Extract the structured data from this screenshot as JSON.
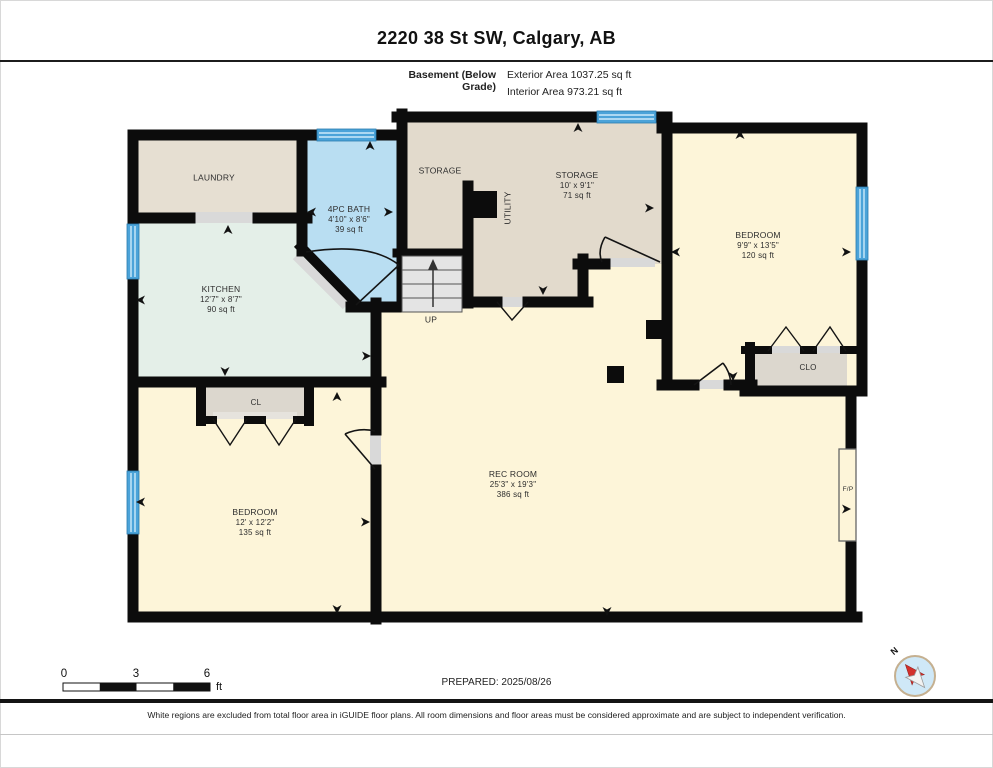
{
  "header": {
    "address": "2220 38 St SW, Calgary, AB",
    "level_label": "Basement (Below Grade)",
    "exterior_area": "Exterior Area 1037.25 sq ft",
    "interior_area": "Interior Area 973.21 sq ft"
  },
  "rooms": {
    "laundry": {
      "name": "LAUNDRY"
    },
    "bath": {
      "name": "4PC BATH",
      "dims": "4'10\" x 8'6\"",
      "area": "39 sq ft"
    },
    "storage_small": {
      "name": "STORAGE"
    },
    "storage": {
      "name": "STORAGE",
      "dims": "10' x 9'1\"",
      "area": "71 sq ft"
    },
    "utility": {
      "name": "UTILITY"
    },
    "bedroom_right": {
      "name": "BEDROOM",
      "dims": "9'9\" x 13'5\"",
      "area": "120 sq ft"
    },
    "kitchen": {
      "name": "KITCHEN",
      "dims": "12'7\" x 8'7\"",
      "area": "90 sq ft"
    },
    "closet_cl": {
      "name": "CL"
    },
    "closet_clo": {
      "name": "CLO"
    },
    "rec_room": {
      "name": "REC ROOM",
      "dims": "25'3\" x 19'3\"",
      "area": "386 sq ft"
    },
    "bedroom_left": {
      "name": "BEDROOM",
      "dims": "12' x 12'2\"",
      "area": "135 sq ft"
    }
  },
  "annotations": {
    "stairs_label": "UP",
    "fireplace_label": "F/P",
    "compass_north": "N"
  },
  "scale_bar": {
    "tick0": "0",
    "tick1": "3",
    "tick2": "6",
    "unit": "ft"
  },
  "footer": {
    "prepared": "PREPARED: 2025/08/26",
    "disclaimer": "White regions are excluded from total floor area in iGUIDE floor plans. All room dimensions and floor areas must be considered approximate and are subject to independent verification."
  },
  "colors": {
    "wall": "#0c0c0c",
    "window": "#4ba3d9",
    "floor_tan": "#e6dfd2",
    "floor_storage": "#e2dacc",
    "floor_blue": "#b9def2",
    "floor_mint": "#e4efe8",
    "floor_cream": "#fdf5d9",
    "closet_gray": "#dcd7ce",
    "threshold_gray": "#d9d9d9",
    "compass_red": "#d32f2a"
  }
}
